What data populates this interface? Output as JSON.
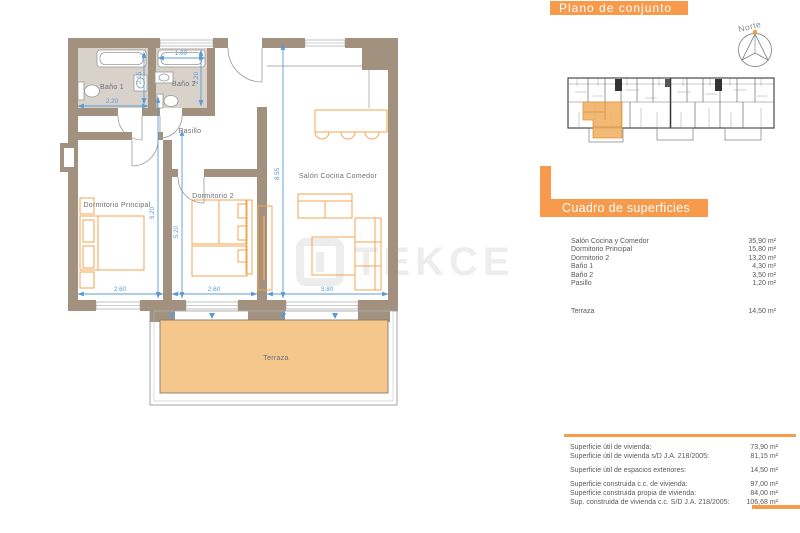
{
  "plan": {
    "rooms": {
      "bano1": "Baño 1",
      "bano2": "Baño 2",
      "pasillo": "Pasillo",
      "dormitorio_principal": "Dormitorio Principal",
      "dormitorio2": "Dormitorio 2",
      "salon": "Salón Cocina Comedor",
      "terraza": "Terraza"
    },
    "dims": {
      "bano1_w": "2.20",
      "bano1_h": "2.15",
      "bano2_w": "1.60",
      "bano2_h": "2.20",
      "dp_w": "2.60",
      "d2_w": "2.60",
      "salon_w": "3.80",
      "dp_h": "6.20",
      "d2_h": "5.20",
      "salon_h": "8.55"
    }
  },
  "overview": {
    "title": "Plano de conjunto",
    "north_label": "Norte"
  },
  "surfaces": {
    "title": "Cuadro de superficies",
    "rows": [
      {
        "label": "Salón Cocina y Comedor",
        "value": "35,90 m²"
      },
      {
        "label": "Dormitorio Principal",
        "value": "15,80 m²"
      },
      {
        "label": "Dormitorio 2",
        "value": "13,20 m²"
      },
      {
        "label": "Baño 1",
        "value": "4,30 m²"
      },
      {
        "label": "Baño 2",
        "value": "3,50 m²"
      },
      {
        "label": "Pasillo",
        "value": "1,20 m²"
      }
    ],
    "terraza_row": {
      "label": "Terraza",
      "value": "14,50 m²"
    }
  },
  "totals": {
    "rows": [
      {
        "label": "Superficie útil de vivienda:",
        "value": "73,90 m²"
      },
      {
        "label": "Superficie útil de vivienda s/D J.A. 218/2005:",
        "value": "81,15 m²"
      },
      {
        "label": "Superficie útil de espacios exteriores:",
        "value": "14,50 m²"
      },
      {
        "label": "Superficie construida c.c. de vivienda:",
        "value": "97,00 m²"
      },
      {
        "label": "Superficie construida propia de vivienda:",
        "value": "84,00 m²"
      },
      {
        "label": "Sup. construida de vivienda c.c. S/D J.A. 218/2005:",
        "value": "106,68 m²"
      }
    ]
  },
  "watermark": {
    "text": "TEKCE"
  },
  "colors": {
    "accent_orange": "#F79A4B",
    "terrace_fill": "#F6C78D",
    "wall": "#A3917F",
    "bath_floor": "#D8D2CA",
    "dim_blue": "#5B9BD5",
    "furniture_orange": "#F0A452",
    "text_gray": "#58595B"
  }
}
